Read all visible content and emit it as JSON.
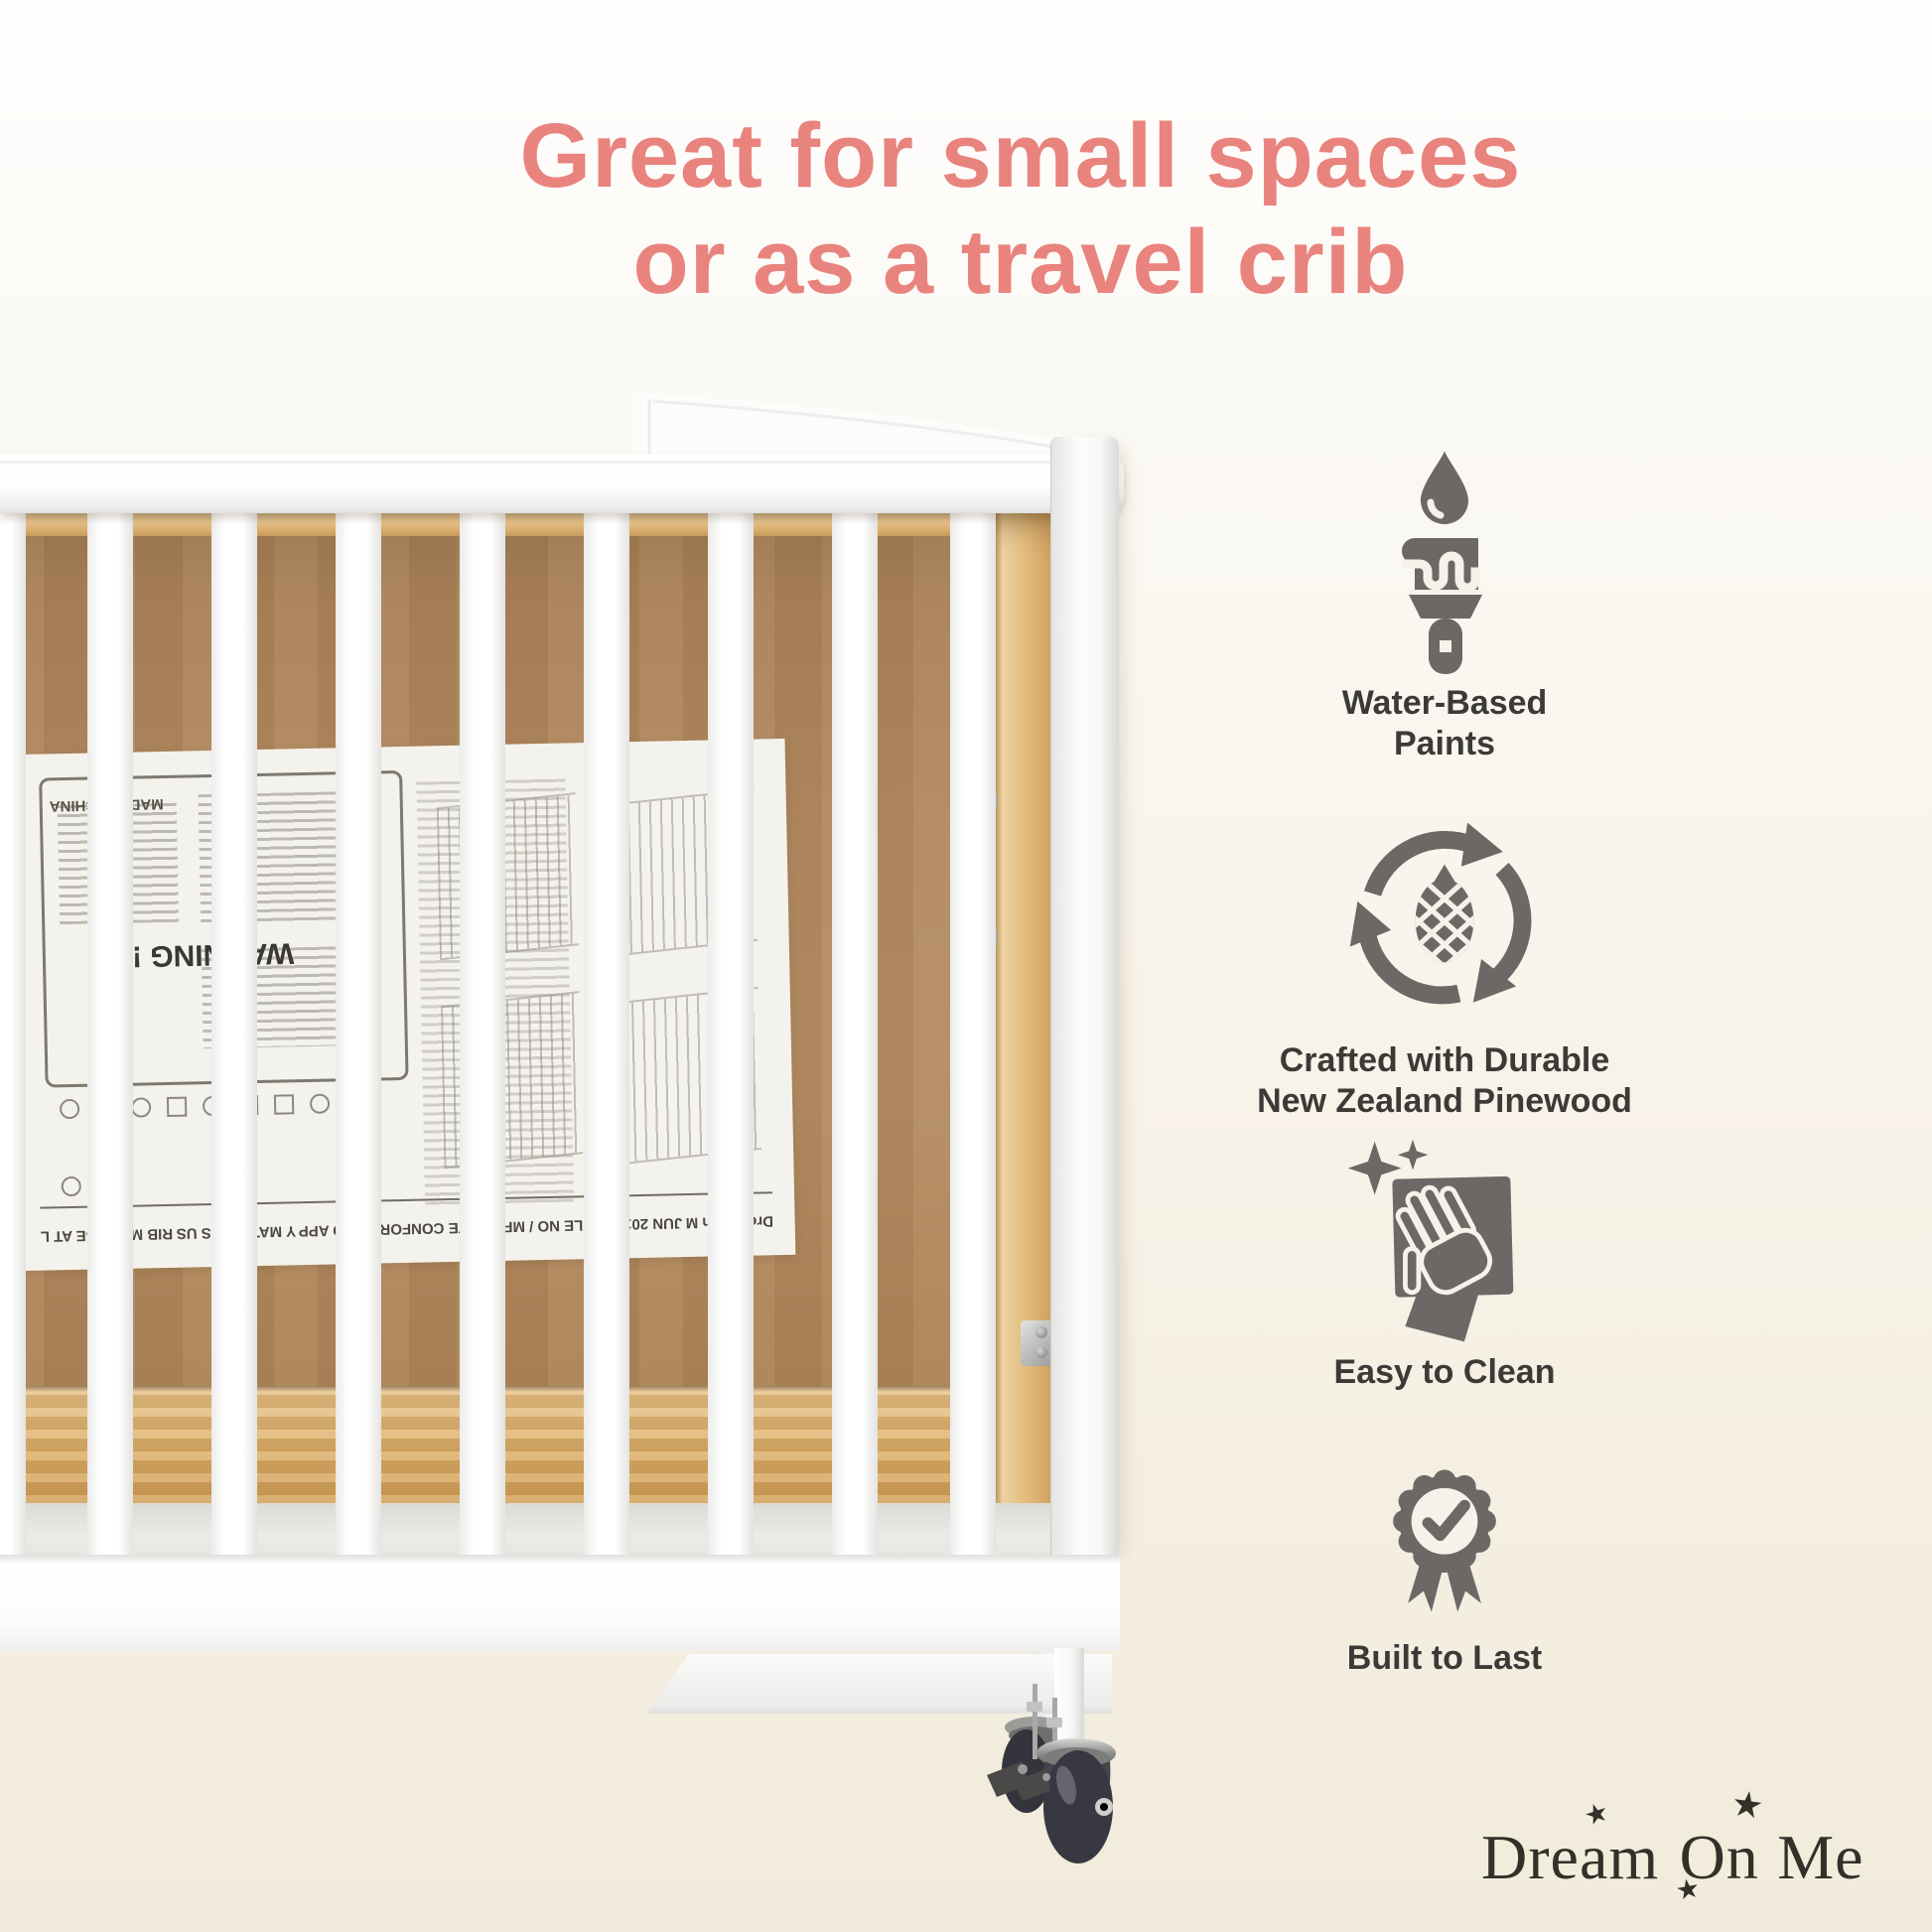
{
  "headline": {
    "line1": "Great for small spaces",
    "line2": "or as a travel crib"
  },
  "features": [
    {
      "icon": "paintbrush-water-droplet-icon",
      "label_lines": [
        "Water-Based",
        "Paints"
      ]
    },
    {
      "icon": "recycle-pinecone-icon",
      "label_lines": [
        "Crafted with Durable",
        "New Zealand Pinewood"
      ]
    },
    {
      "icon": "hand-wipe-sparkle-icon",
      "label_lines": [
        "Easy to Clean"
      ]
    },
    {
      "icon": "award-badge-check-icon",
      "label_lines": [
        "Built to Last"
      ]
    }
  ],
  "logo": {
    "words": [
      "Dream",
      "On",
      "Me"
    ],
    "star_glyph": "★"
  },
  "sheet": {
    "fragments": [
      "WARNING !",
      "MADE IN CHINA",
      "RIB MUST BE AT L",
      "Y MATTRESS US",
      "CONFORMS TO APP",
      "STYLE NO / MFG DATE",
      "JUN 2017",
      "Dream On M"
    ]
  },
  "colors": {
    "headline": "#e9837e",
    "icon_gray": "#6b6866",
    "logo_text": "#33302a",
    "panel_brown": "#b2895f",
    "pine_wood": "#e0b67a",
    "crib_white": "#fdfdfd",
    "background_bottom": "#f1ebdb"
  }
}
